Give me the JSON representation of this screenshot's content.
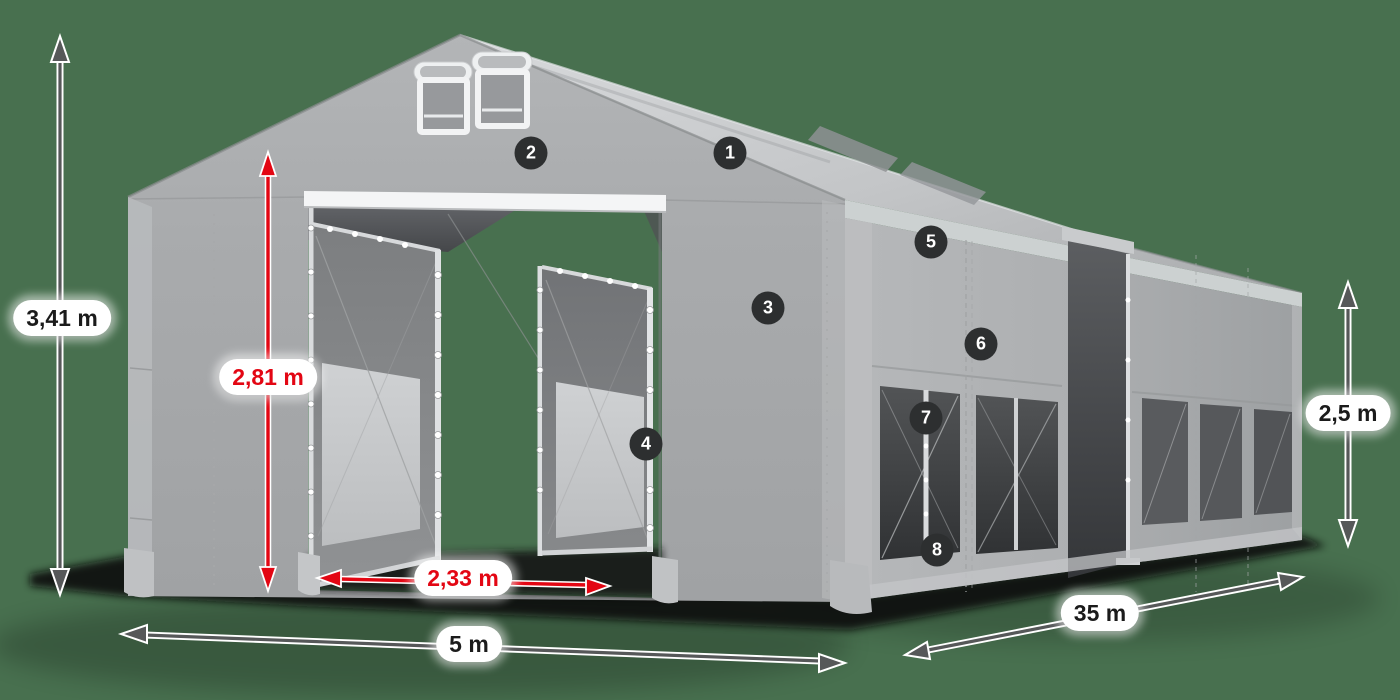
{
  "dimensions": {
    "total_height": "3,41 m",
    "entrance_height": "2,81 m",
    "entrance_width": "2,33 m",
    "width": "5 m",
    "length": "35 m",
    "side_height": "2,5 m"
  },
  "callouts": [
    "1",
    "2",
    "3",
    "4",
    "5",
    "6",
    "7",
    "8"
  ],
  "colors": {
    "background": "#48704f",
    "accent_red": "#e30613",
    "arrow_gray": "#565859",
    "badge_background": "#2d2f30",
    "tent_fabric_light": "#c9cbcd",
    "tent_fabric_mid": "#a8aaac",
    "tent_mesh_dark": "#56585b",
    "label_text": "#1b1b1b"
  }
}
